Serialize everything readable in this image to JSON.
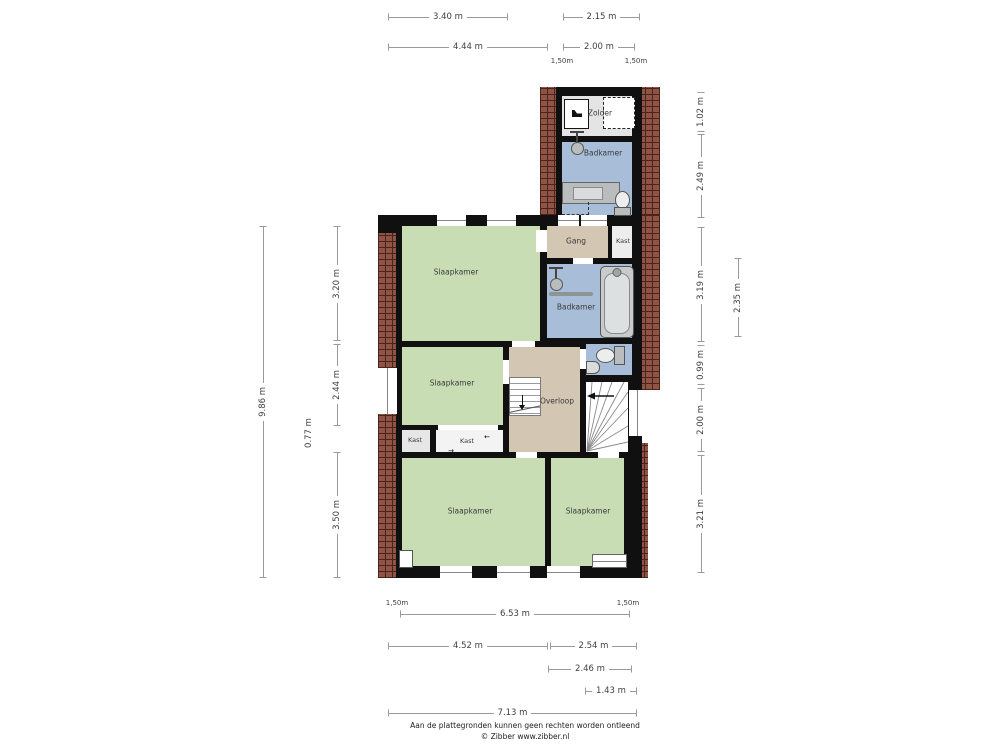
{
  "footer": {
    "line1": "Aan de plattegronden kunnen geen rechten worden ontleend",
    "line2": "© Zibber www.zibber.nl"
  },
  "rooms": {
    "zolder": "Zolder",
    "badkamer_top": "Badkamer",
    "gang": "Gang",
    "kast_gang": "Kast",
    "badkamer": "Badkamer",
    "slaapkamer_tl": "Slaapkamer",
    "slaapkamer_ml": "Slaapkamer",
    "kast_left": "Kast",
    "kast_mid": "Kast",
    "overloop": "Overloop",
    "slaapkamer_bl": "Slaapkamer",
    "slaapkamer_br": "Slaapkamer"
  },
  "dims": {
    "t_340": "3.40 m",
    "t_215": "2.15 m",
    "t_444": "4.44 m",
    "t_200": "2.00 m",
    "t_150a": "1,50m",
    "t_150b": "1,50m",
    "r_102": "1.02 m",
    "r_249": "2.49 m",
    "r_319": "3.19 m",
    "r_235": "2.35 m",
    "r_099": "0.99 m",
    "r_200": "2.00 m",
    "r_321": "3.21 m",
    "l_986": "9.86 m",
    "l_320": "3.20 m",
    "l_244": "2.44 m",
    "l_077": "0.77 m",
    "l_350": "3.50 m",
    "b_150a": "1,50m",
    "b_150b": "1,50m",
    "b_653": "6.53 m",
    "b_452": "4.52 m",
    "b_254": "2.54 m",
    "b_246": "2.46 m",
    "b_143": "1.43 m",
    "b_713": "7.13 m"
  },
  "glyphs": {
    "arrow_left": "←",
    "arrow_right": "→"
  },
  "colors": {
    "wall": "#101010",
    "brick": "#8f5446",
    "brickline": "#4a241b",
    "dimline": "#9a9a9a",
    "floor_bedroom": "#c9ddb4",
    "floor_bath": "#a7bdd8",
    "floor_hall": "#d3c6b2",
    "floor_attic": "#e4e4e4",
    "floor_closet": "#ededed",
    "text": "#3a3a3a"
  }
}
